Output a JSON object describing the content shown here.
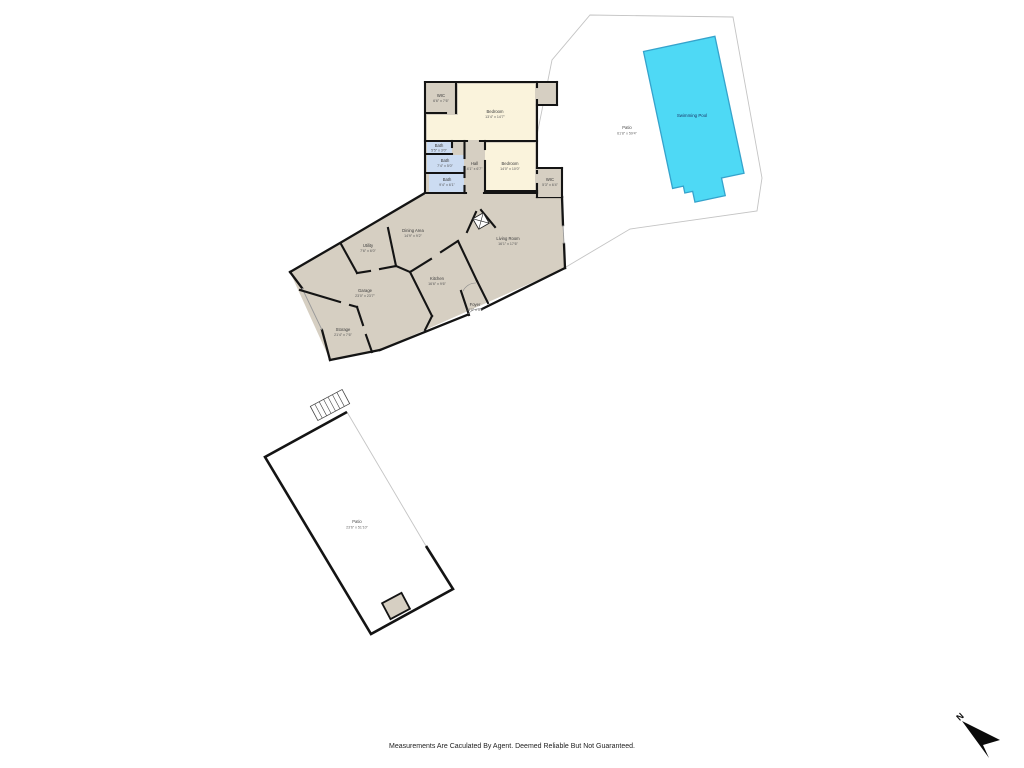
{
  "footer": {
    "disclaimer": "Measurements Are Caculated By Agent. Deemed Reliable But Not Guaranteed."
  },
  "compass": {
    "label": "N"
  },
  "rooms": {
    "wic_upper": {
      "name": "WIC",
      "dims": "6'6\" x 7'6\""
    },
    "bedroom_main": {
      "name": "Bedroom",
      "dims": "13'4\" x 14'7\""
    },
    "bath_small": {
      "name": "Bath",
      "dims": "5'5\" x 3'0\""
    },
    "bath_mid": {
      "name": "Bath",
      "dims": "7'4\" x 5'0\""
    },
    "bath_lower": {
      "name": "Bath",
      "dims": "9'4\" x 6'1\""
    },
    "hall": {
      "name": "Hall",
      "dims": "4'1\" x 6'7\""
    },
    "bedroom_right": {
      "name": "Bedroom",
      "dims": "14'0\" x 10'0\""
    },
    "wic_right": {
      "name": "WIC",
      "dims": "5'3\" x 6'4\""
    },
    "dining": {
      "name": "Dining Area",
      "dims": "14'9\" x 9'2\""
    },
    "utility": {
      "name": "Utility",
      "dims": "7'6\" x 6'0\""
    },
    "living": {
      "name": "Living Room",
      "dims": "16'1\" x 17'6\""
    },
    "kitchen": {
      "name": "Kitchen",
      "dims": "16'6\" x 9'6\""
    },
    "foyer": {
      "name": "Foyer",
      "dims": "10'0\" x 5'5\""
    },
    "garage": {
      "name": "Garage",
      "dims": "23'0\" x 23'7\""
    },
    "storage": {
      "name": "Storage",
      "dims": "21'4\" x 7'6\""
    }
  },
  "areas": {
    "pool": {
      "name": "Swimming Pool"
    },
    "pool_patio": {
      "name": "Patio",
      "dims": "61'8\" x 59'4\""
    },
    "lower_patio": {
      "name": "Patio",
      "dims": "23'6\" x 51'10\""
    }
  },
  "colors": {
    "floor_tan": "#d6cfc2",
    "room_cream": "#faf3dc",
    "bath_blue": "#ccdcf2",
    "pool_fill": "#4ed9f5",
    "pool_border": "#35a3cc",
    "wall": "#141414",
    "patio_outline": "#c4c4c4",
    "label_text": "#3a3a3a",
    "pool_label_text": "#1c3667"
  }
}
